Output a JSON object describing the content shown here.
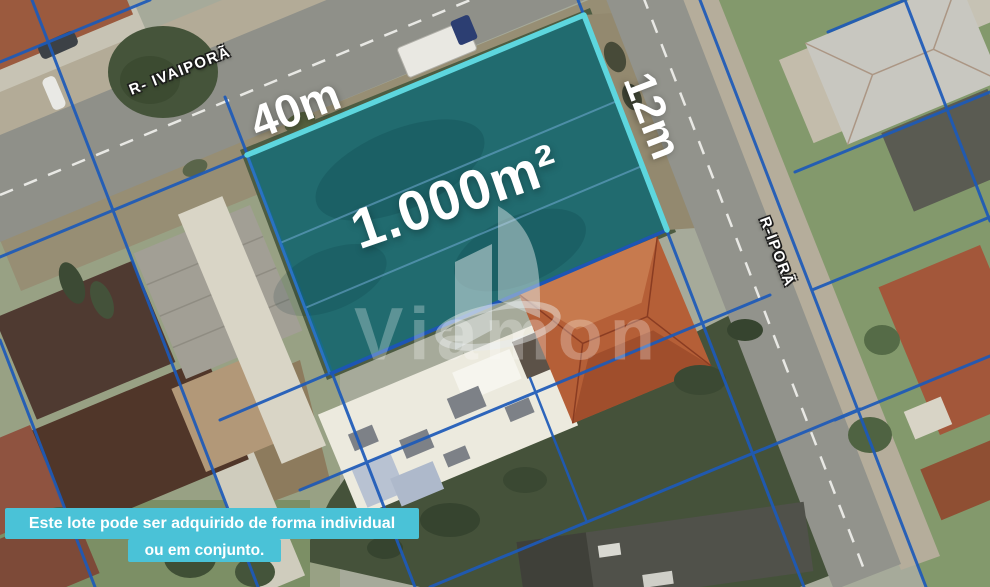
{
  "map": {
    "streets": {
      "ivaipora": "R- IVAIPORÃ",
      "ipora": "R-IPORÃ"
    },
    "lot": {
      "frontage": "40m",
      "side": "12m",
      "area": "1.000m²"
    },
    "watermark": "Viamon",
    "caption": {
      "line1": "Este lote pode ser adquirido de forma individual",
      "line2": "ou em conjunto."
    },
    "colors": {
      "lot_fill": "#15707c",
      "lot_border": "#5dd6de",
      "boundary_blue": "#1d5ab9",
      "caption_bg": "#4ac2d7"
    }
  }
}
